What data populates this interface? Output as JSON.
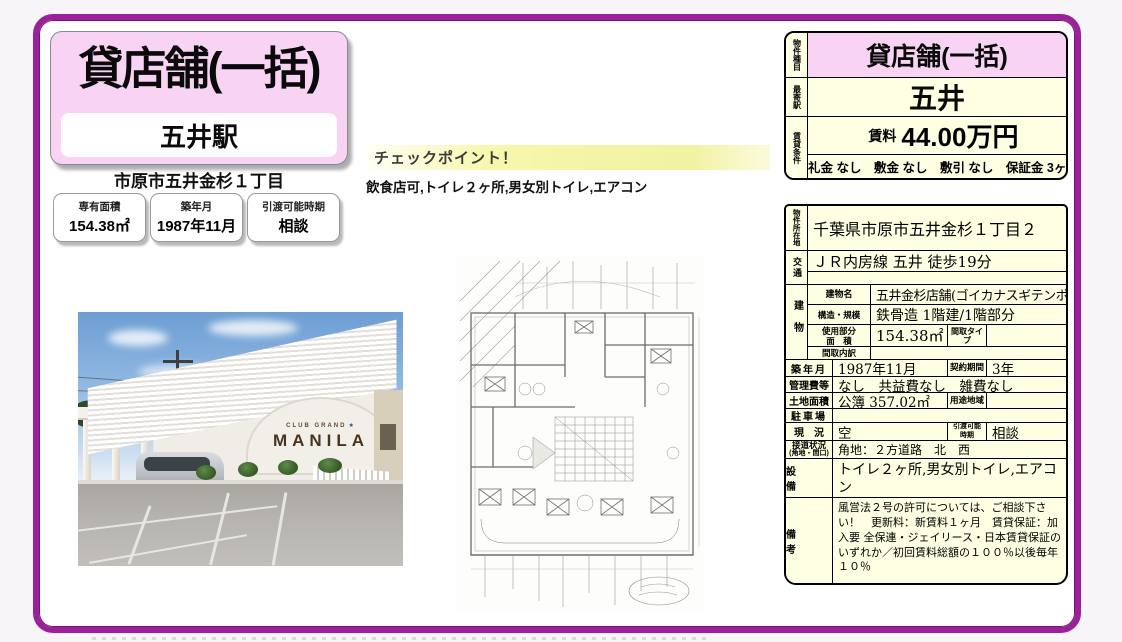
{
  "page": {
    "title": "貸店舗(一括)",
    "station_box": "五井駅",
    "address_short": "市原市五井金杉１丁目",
    "chips": [
      {
        "label": "専有面積",
        "value": "154.38㎡"
      },
      {
        "label": "築年月",
        "value": "1987年11月"
      },
      {
        "label": "引渡可能時期",
        "value": "相談"
      }
    ],
    "checkpoint": {
      "title": "チェックポイント！",
      "text": "飲食店可,トイレ２ヶ所,男女別トイレ,エアコン"
    },
    "photo_sign": {
      "line1": "CLUB GRAND",
      "line2": "MANILA",
      "stars": "★"
    },
    "colors": {
      "frame_purple": "#99219a",
      "accent_pink": "#f8d3f3",
      "cell_cream": "#ffffe3",
      "checkpoint_yellow": "#f2f2a2"
    }
  },
  "panel": {
    "property_type": {
      "label": "物件種目",
      "value": "貸店舗(一括)"
    },
    "nearest_station": {
      "label": "最寄駅",
      "value": "五井"
    },
    "rent": {
      "label": "賃貸条件",
      "rent_label": "賃料",
      "rent_value": "44.00万円",
      "conditions": "礼金 なし　敷金 なし　敷引 なし　保証金 3ヶ月"
    },
    "location": {
      "label": "物件所在地",
      "value": "千葉県市原市五井金杉１丁目２"
    },
    "access": {
      "label": "交通",
      "value": "ＪＲ内房線 五井 徒歩19分",
      "value2": ""
    },
    "building": {
      "label": "建物",
      "name_label": "建物名",
      "name": "五井金杉店舗(ゴイカナスギテンポ)",
      "structure_label": "構造・規模",
      "structure": "鉄骨造 1階建/1階部分",
      "area_label1": "使用部分",
      "area_label2": "面　積",
      "area": "154.38㎡",
      "madori_type_label": "間取タイプ",
      "madori_type": "",
      "madori_breakdown_label": "間取内訳",
      "madori_breakdown": ""
    },
    "built": {
      "label": "築年月",
      "value": "1987年11月",
      "contract_label": "契約期間",
      "contract_value": "3年"
    },
    "fees": {
      "label": "管理費等",
      "value": "なし　共益費なし　雑費なし"
    },
    "land": {
      "label": "土地面積",
      "value": "公簿 357.02㎡",
      "zoning_label": "用途地域",
      "zoning_value": ""
    },
    "parking": {
      "label": "駐車場",
      "value": ""
    },
    "status": {
      "label": "現　況",
      "value": "空",
      "handover_label1": "引渡可能",
      "handover_label2": "時期",
      "handover_value": "相談"
    },
    "road": {
      "label1": "接道状況",
      "label2": "(角地・間口)",
      "value": "角地：２方道路　北　西"
    },
    "equipment": {
      "label": "設　備",
      "value": "トイレ２ヶ所,男女別トイレ,エアコン"
    },
    "notes": {
      "label": "備　考",
      "value": "風営法２号の許可については、ご相談下さい！　更新料：新賃料１ヶ月　賃貸保証：加入要 全保連・ジェイリース・日本賃貸保証のいずれか／初回賃料総額の１００％以後毎年１０％"
    }
  }
}
